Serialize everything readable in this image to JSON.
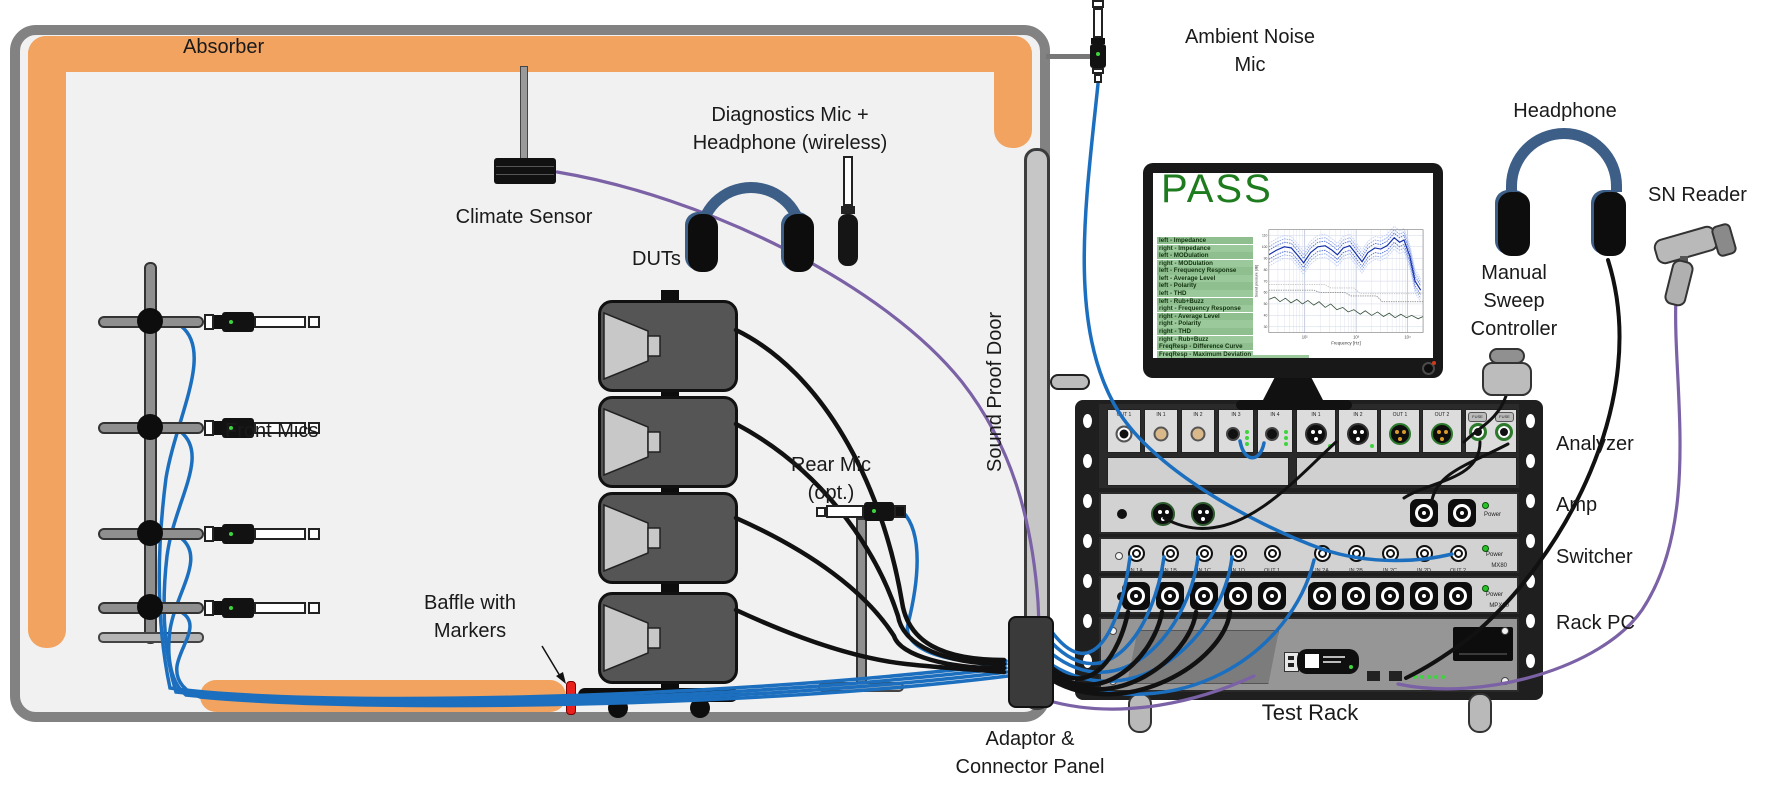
{
  "colors": {
    "absorber_orange": "#F2A35F",
    "cable_blue": "#1C6FBE",
    "cable_purple": "#7B61A5",
    "cable_black": "#111111",
    "pass_green": "#1E7C1E",
    "list_green": "#8FBE8F",
    "headphone_blue": "#3D5E86"
  },
  "chamber": {
    "absorber": "Absorber",
    "climate_sensor": "Climate Sensor",
    "front_mics": "Front Mics",
    "duts": "DUTs",
    "diag_line1": "Diagnostics Mic +",
    "diag_line2": "Headphone (wireless)",
    "baffle_line1": "Baffle with",
    "baffle_line2": "Markers",
    "rear_line1": "Rear Mic",
    "rear_line2": "(opt.)",
    "door": "Sound Proof Door"
  },
  "outside": {
    "ambient_line1": "Ambient Noise",
    "ambient_line2": "Mic",
    "headphone": "Headphone",
    "sn_reader": "SN Reader",
    "manual_lines": [
      "Manual",
      "Sweep",
      "Controller"
    ],
    "adaptor_line1": "Adaptor &",
    "adaptor_line2": "Connector Panel",
    "test_rack": "Test Rack"
  },
  "rack": {
    "row_labels": [
      "Analyzer",
      "Amp",
      "Switcher",
      "Rack PC"
    ],
    "analyzer_ports_left": [
      "OUT 1",
      "IN 1",
      "IN 2",
      "IN 3",
      "IN 4"
    ],
    "analyzer_ports_xlr": [
      "IN 1",
      "IN 2",
      "OUT 1",
      "OUT 2"
    ],
    "switcher_ports": [
      "IN 1A",
      "IN 1B",
      "IN 1C",
      "IN 1D",
      "OUT 1",
      "IN 2A",
      "IN 2B",
      "IN 2C",
      "IN 2D",
      "OUT 2"
    ],
    "power_label": "Power",
    "model_switch_a": "MX80",
    "model_switch_b": "MPX80",
    "fuse_label": "FUSE"
  },
  "monitor": {
    "status": "PASS",
    "tests": [
      "left - Impedance",
      "right - Impedance",
      "left - MODulation",
      "right - MODulation",
      "left - Frequency Response",
      "left - Average Level",
      "left - Polarity",
      "left - THD",
      "left - Rub+Buzz",
      "right - Frequency Response",
      "right - Average Level",
      "right - Polarity",
      "right - THD",
      "right - Rub+Buzz",
      "FreqResp - Difference Curve",
      "FreqResp - Maximum Deviation"
    ]
  },
  "chart_data": {
    "type": "line",
    "title": "",
    "xlabel": "Frequency [Hz]",
    "ylabel": "Sound pressure [dB]",
    "x_scale": "log",
    "xlim": [
      20,
      20000
    ],
    "ylim": [
      25,
      115
    ],
    "y_ticks": [
      110,
      100,
      90,
      80,
      70,
      60,
      50,
      40,
      30
    ],
    "x_ticks": [
      "10²",
      "10³",
      "10⁴"
    ],
    "x_tick_freqs": [
      100,
      1000,
      10000
    ],
    "grid_freqs": [
      30,
      40,
      50,
      60,
      70,
      80,
      90,
      100,
      200,
      300,
      400,
      500,
      600,
      700,
      800,
      900,
      1000,
      2000,
      3000,
      4000,
      5000,
      6000,
      7000,
      8000,
      9000,
      10000,
      20000
    ],
    "legend": [
      "response mean + tolerance bands",
      "limit curves",
      "noise floor"
    ],
    "response_color": "#1430A8",
    "band_offsets": [
      4,
      7,
      10
    ],
    "band_colors": [
      "#4F6FD6",
      "#8FA6EA",
      "#C6D2F6"
    ],
    "response": [
      [
        20,
        93
      ],
      [
        28,
        97
      ],
      [
        40,
        100
      ],
      [
        55,
        99
      ],
      [
        75,
        92
      ],
      [
        95,
        86
      ],
      [
        130,
        95
      ],
      [
        180,
        100
      ],
      [
        250,
        101
      ],
      [
        340,
        97
      ],
      [
        430,
        93
      ],
      [
        560,
        99
      ],
      [
        750,
        101
      ],
      [
        950,
        95
      ],
      [
        1300,
        87
      ],
      [
        1700,
        95
      ],
      [
        2300,
        99
      ],
      [
        3000,
        98
      ],
      [
        4000,
        101
      ],
      [
        5500,
        108
      ],
      [
        7000,
        104
      ],
      [
        8500,
        106
      ],
      [
        11000,
        92
      ],
      [
        14000,
        70
      ],
      [
        18000,
        62
      ]
    ],
    "noise": [
      [
        20,
        54
      ],
      [
        26,
        56
      ],
      [
        33,
        52
      ],
      [
        42,
        55
      ],
      [
        54,
        51
      ],
      [
        70,
        54
      ],
      [
        90,
        50
      ],
      [
        115,
        53
      ],
      [
        150,
        49
      ],
      [
        190,
        52
      ],
      [
        250,
        47
      ],
      [
        320,
        50
      ],
      [
        420,
        45
      ],
      [
        550,
        47
      ],
      [
        700,
        43
      ],
      [
        900,
        45
      ],
      [
        1200,
        41
      ],
      [
        1500,
        44
      ],
      [
        2000,
        40
      ],
      [
        2600,
        43
      ],
      [
        3400,
        39
      ],
      [
        4400,
        42
      ],
      [
        5700,
        38
      ],
      [
        7400,
        41
      ],
      [
        9500,
        38
      ],
      [
        12000,
        40
      ],
      [
        16000,
        37
      ],
      [
        20000,
        39
      ]
    ],
    "limit_upper": [
      [
        20,
        67
      ],
      [
        250,
        67
      ],
      [
        320,
        64
      ],
      [
        900,
        64
      ],
      [
        1200,
        59
      ],
      [
        20000,
        59
      ]
    ],
    "limit_lower": [
      [
        20,
        62
      ],
      [
        150,
        62
      ],
      [
        200,
        60
      ],
      [
        600,
        60
      ],
      [
        800,
        57
      ],
      [
        2500,
        57
      ],
      [
        3200,
        52
      ],
      [
        20000,
        52
      ]
    ]
  }
}
